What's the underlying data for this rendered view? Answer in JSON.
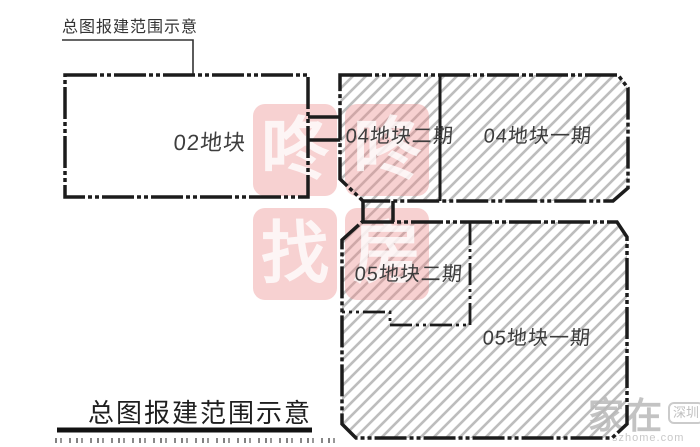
{
  "page": {
    "background": "#ffffff"
  },
  "annotations": {
    "top_callout": "总图报建范围示意",
    "bottom_title": "总图报建范围示意"
  },
  "parcels": [
    {
      "id": "02",
      "label": "02地块",
      "hatched": false
    },
    {
      "id": "04-phase2",
      "label": "04地块二期",
      "hatched": true
    },
    {
      "id": "04-phase1",
      "label": "04地块一期",
      "hatched": true
    },
    {
      "id": "05-phase2",
      "label": "05地块二期",
      "hatched": true
    },
    {
      "id": "05-phase1",
      "label": "05地块一期",
      "hatched": true
    }
  ],
  "watermarks": {
    "dongdong": {
      "chars": [
        "咚",
        "咚",
        "找",
        "房"
      ],
      "tile_color": "#ec8c8c",
      "char_color": "#ffffff"
    },
    "szhome": {
      "large_text": "家在",
      "badge_text": "深圳",
      "url_text": "szhome.com",
      "color": "#c6c6c6"
    }
  },
  "colors": {
    "line": "#1c1c1c",
    "hatch": "#bdbdbd",
    "label_text": "#3d3d3d"
  }
}
